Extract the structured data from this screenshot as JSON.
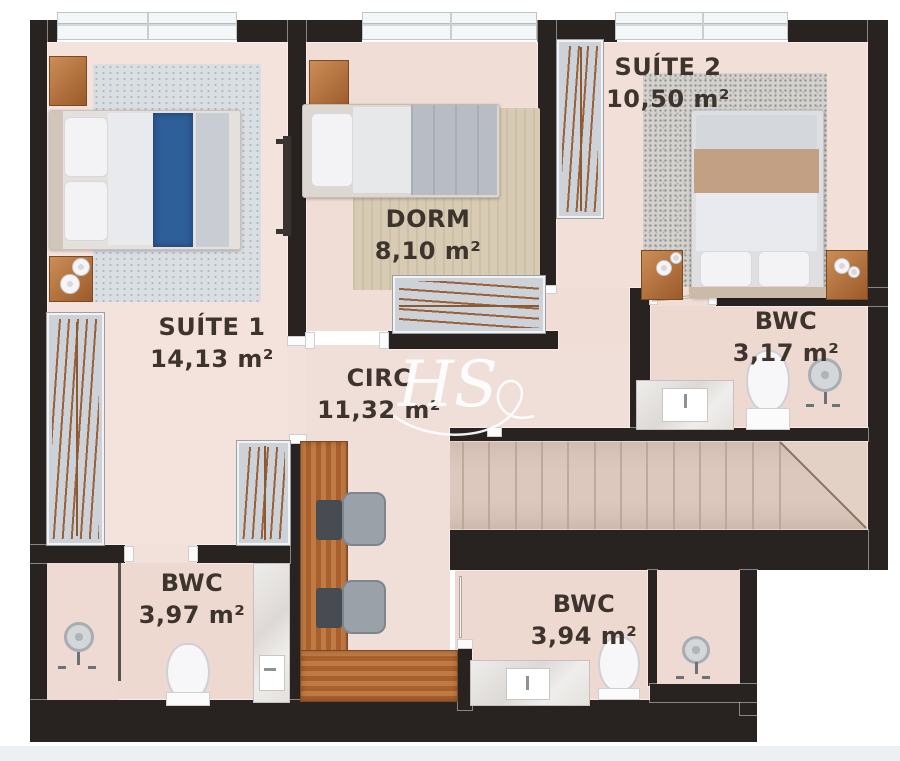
{
  "watermark": {
    "text": "HS"
  },
  "rooms": {
    "suite1": {
      "name": "SUÍTE 1",
      "area": "14,13 m²"
    },
    "dorm": {
      "name": "DORM",
      "area": "8,10 m²"
    },
    "suite2": {
      "name": "SUÍTE 2",
      "area": "10,50 m²"
    },
    "bwc_suite2": {
      "name": "BWC",
      "area": "3,17 m²"
    },
    "circ": {
      "name": "CIRC",
      "area": "11,32 m²"
    },
    "bwc_suite1": {
      "name": "BWC",
      "area": "3,97 m²"
    },
    "bwc_social": {
      "name": "BWC",
      "area": "3,94 m²"
    }
  },
  "palette": {
    "wall": "#282221",
    "floor": "#f1ded7",
    "bed_runner_blue": "#2e5f99",
    "wood": "#b06f3e",
    "label_text": "#3e342e"
  }
}
